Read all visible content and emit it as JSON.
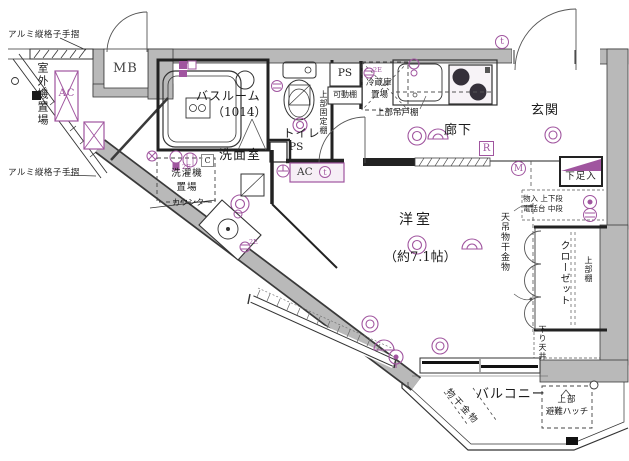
{
  "rooms": {
    "western_room": "洋室",
    "western_room_size": "（約7.1帖）",
    "bathroom": "バスルーム",
    "bathroom_size": "（1014）",
    "washroom": "洗面室",
    "toilet": "トイレ",
    "entrance": "玄関",
    "corridor": "廊下",
    "balcony": "バルコニー",
    "closet": "クローゼット",
    "meter_box": "MB",
    "outdoor_unit_space": "室外機置場"
  },
  "labels": {
    "handrail_top": "アルミ縦格子手摺",
    "handrail_bottom": "アルミ縦格子手摺",
    "ac_outdoor": "AC",
    "ac_wall": "AC",
    "washer_space_line1": "洗濯機",
    "washer_space_line2": "置場",
    "counter": "カウンター",
    "ps_toilet": "PS",
    "ps_kitchen": "PS",
    "movable_shelf": "可動棚",
    "fridge_space_line1": "冷蔵庫",
    "fridge_space_line2": "置場",
    "upper_hanging_cupboard": "上部吊戸棚",
    "upper_fixed_shelf": "上部固定棚",
    "shoe_box": "下足入",
    "storage_upper_lower": "物入 上下段",
    "phone_stand_middle": "電話台 中段",
    "ceiling_laundry_hardware": "天吊物干金物",
    "upper_shelf": "上部棚",
    "lowered_ceiling": "下り天井",
    "balcony_laundry_hardware": "物干金物",
    "escape_hatch_line1": "上部",
    "escape_hatch_line2": "避難ハッチ"
  },
  "marks": {
    "refrigerator": "R",
    "meter": "M",
    "thermostat": "t",
    "c_box": "C",
    "outlet_2e": "2E"
  },
  "colors": {
    "wall_fill": "#b9b9b9",
    "accent": "#a0559f",
    "line": "#2b2b2b"
  }
}
